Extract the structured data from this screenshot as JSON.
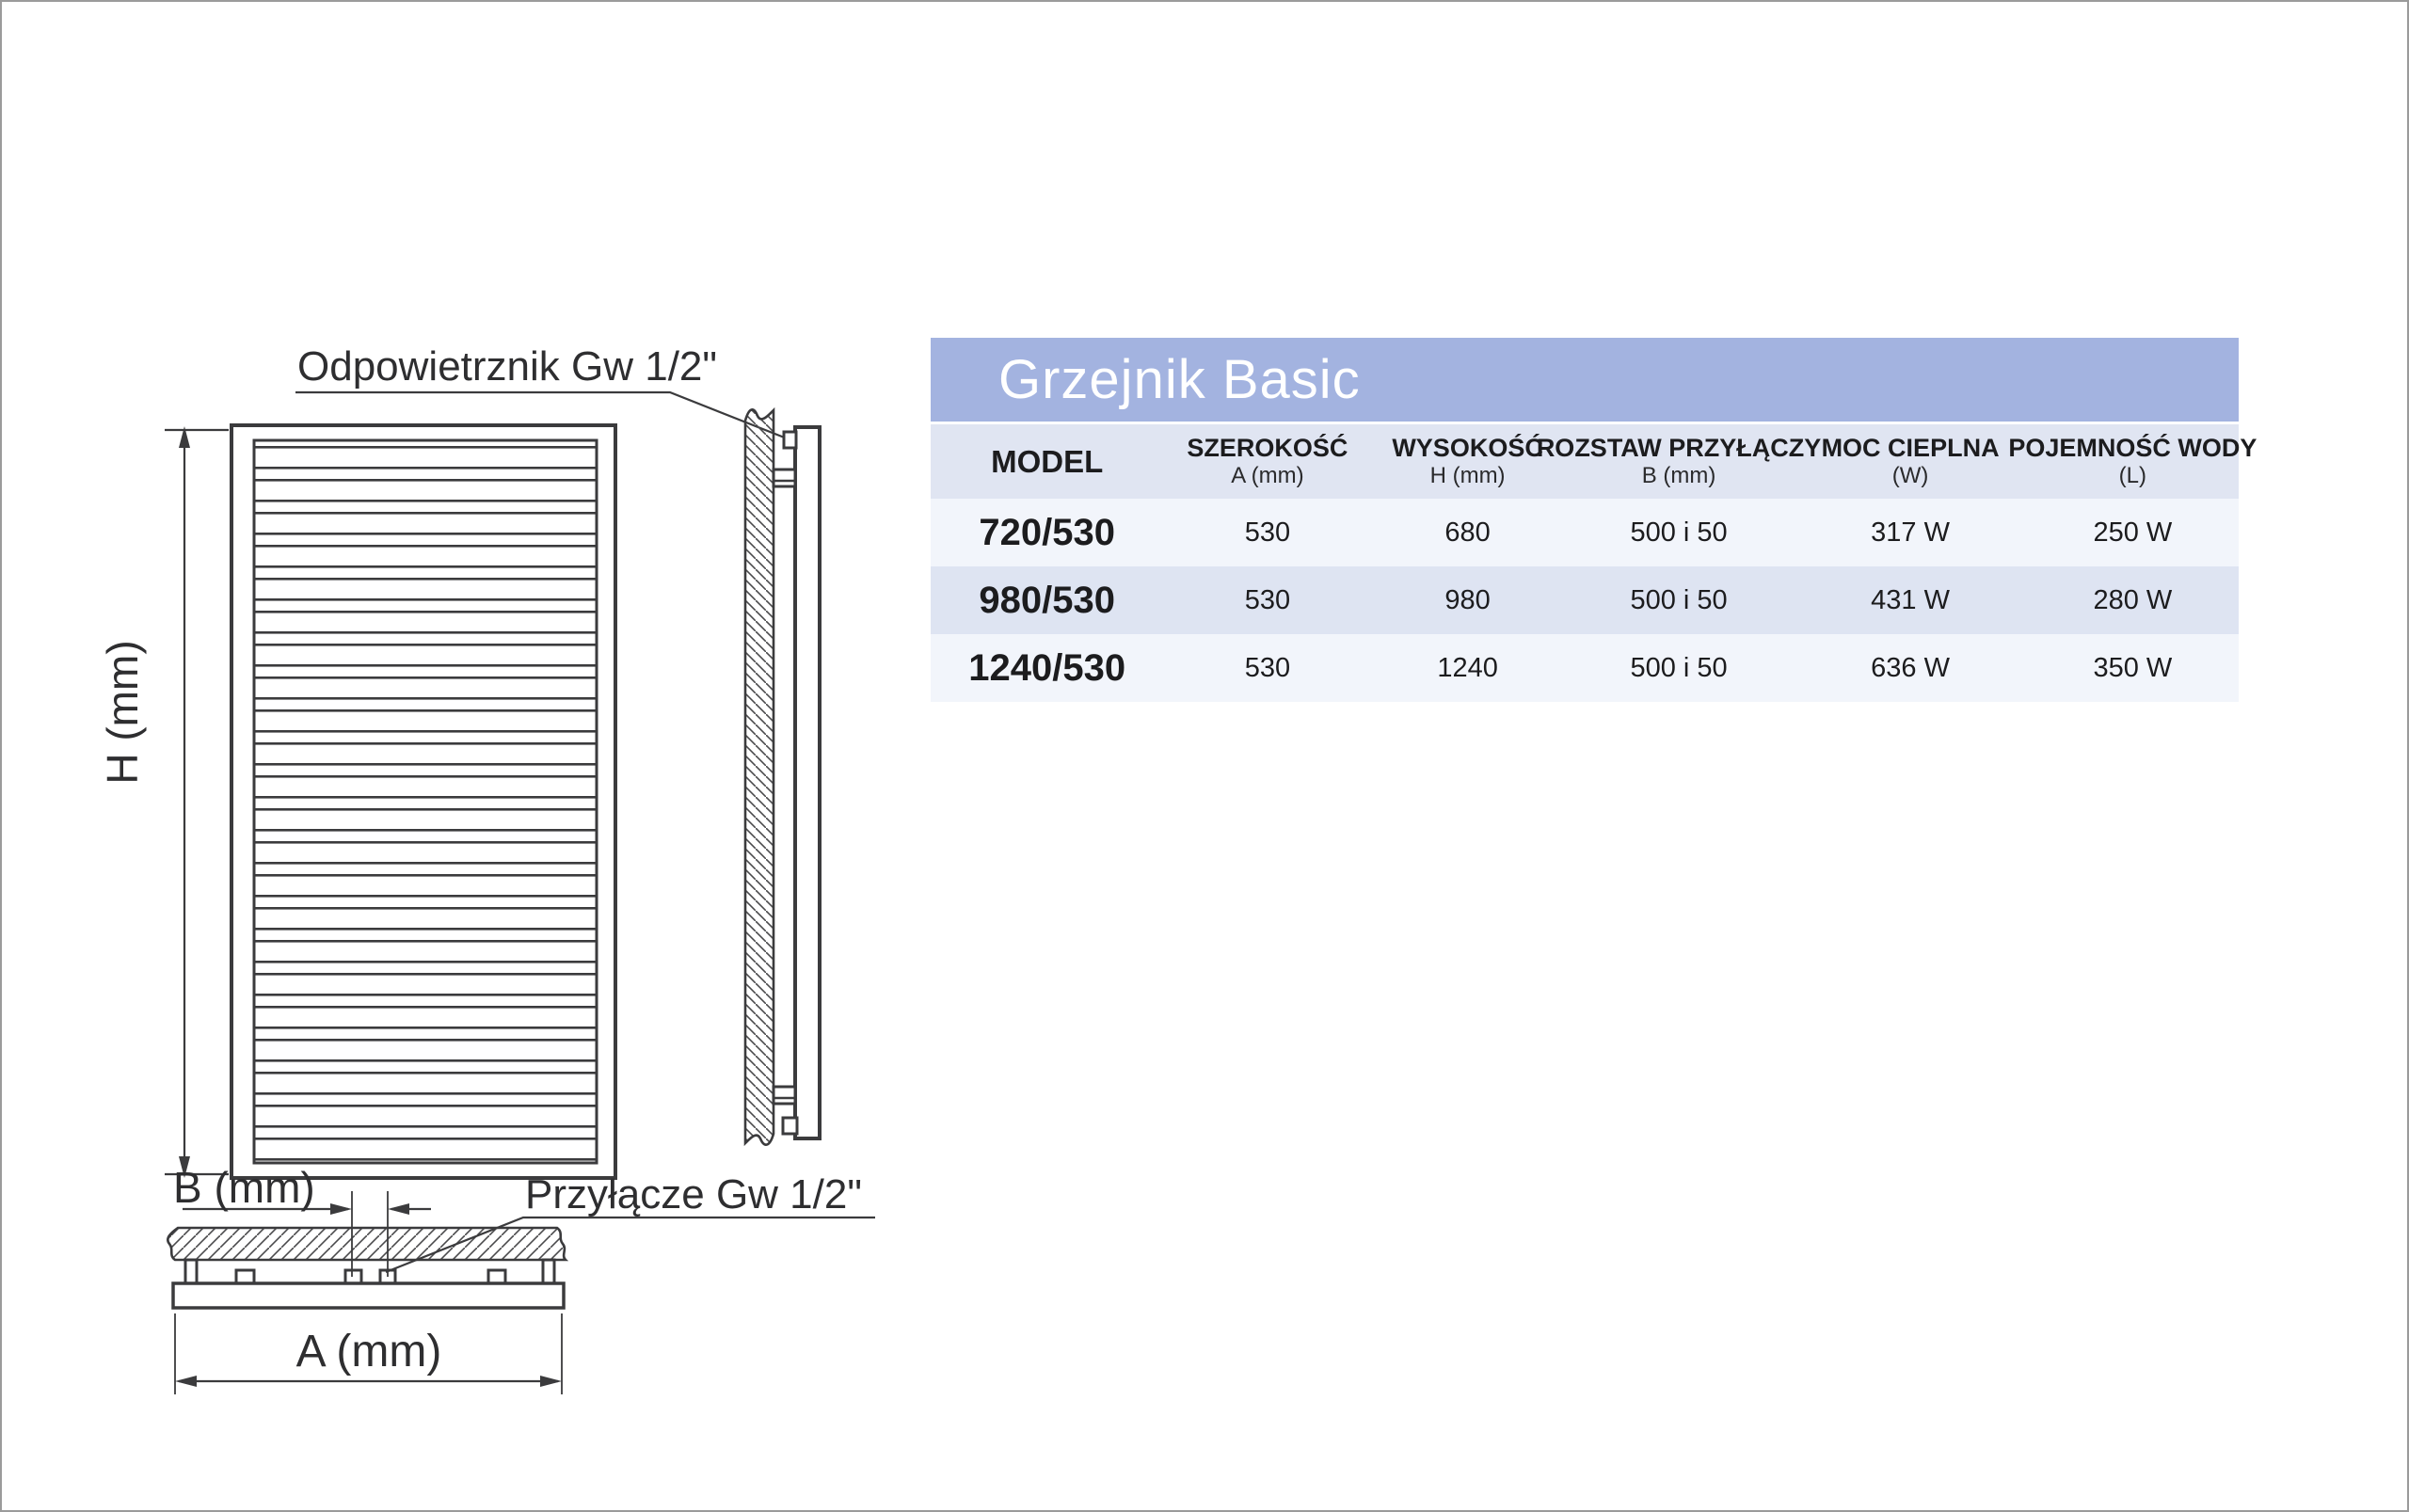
{
  "diagram": {
    "labels": {
      "air_vent": "Odpowietrznik Gw 1/2\"",
      "height_dim": "H (mm)",
      "spacing_dim": "B (mm)",
      "connection": "Przyłącze Gw 1/2\"",
      "width_dim": "A (mm)"
    },
    "line_color": "#3b3b3d"
  },
  "table": {
    "title": "Grzejnik Basic",
    "colors": {
      "title_bg": "#a3b3e0",
      "header_bg": "#e0e5f2",
      "row_light": "#f2f5fb",
      "row_dark": "#dee4f2"
    },
    "columns": [
      {
        "label": "MODEL",
        "sub": ""
      },
      {
        "label": "SZEROKOŚĆ",
        "sub": "A (mm)"
      },
      {
        "label": "WYSOKOŚĆ",
        "sub": "H (mm)"
      },
      {
        "label": "ROZSTAW PRZYŁĄCZY",
        "sub": "B (mm)"
      },
      {
        "label": "MOC CIEPLNA",
        "sub": "(W)"
      },
      {
        "label": "POJEMNOŚĆ WODY",
        "sub": "(L)"
      }
    ],
    "rows": [
      {
        "model": "720/530",
        "szerokosc": "530",
        "wysokosc": "680",
        "rozstaw": "500 i 50",
        "moc": "317 W",
        "pojemnosc": "250 W"
      },
      {
        "model": "980/530",
        "szerokosc": "530",
        "wysokosc": "980",
        "rozstaw": "500 i 50",
        "moc": "431 W",
        "pojemnosc": "280 W"
      },
      {
        "model": "1240/530",
        "szerokosc": "530",
        "wysokosc": "1240",
        "rozstaw": "500 i 50",
        "moc": "636 W",
        "pojemnosc": "350 W"
      }
    ]
  }
}
